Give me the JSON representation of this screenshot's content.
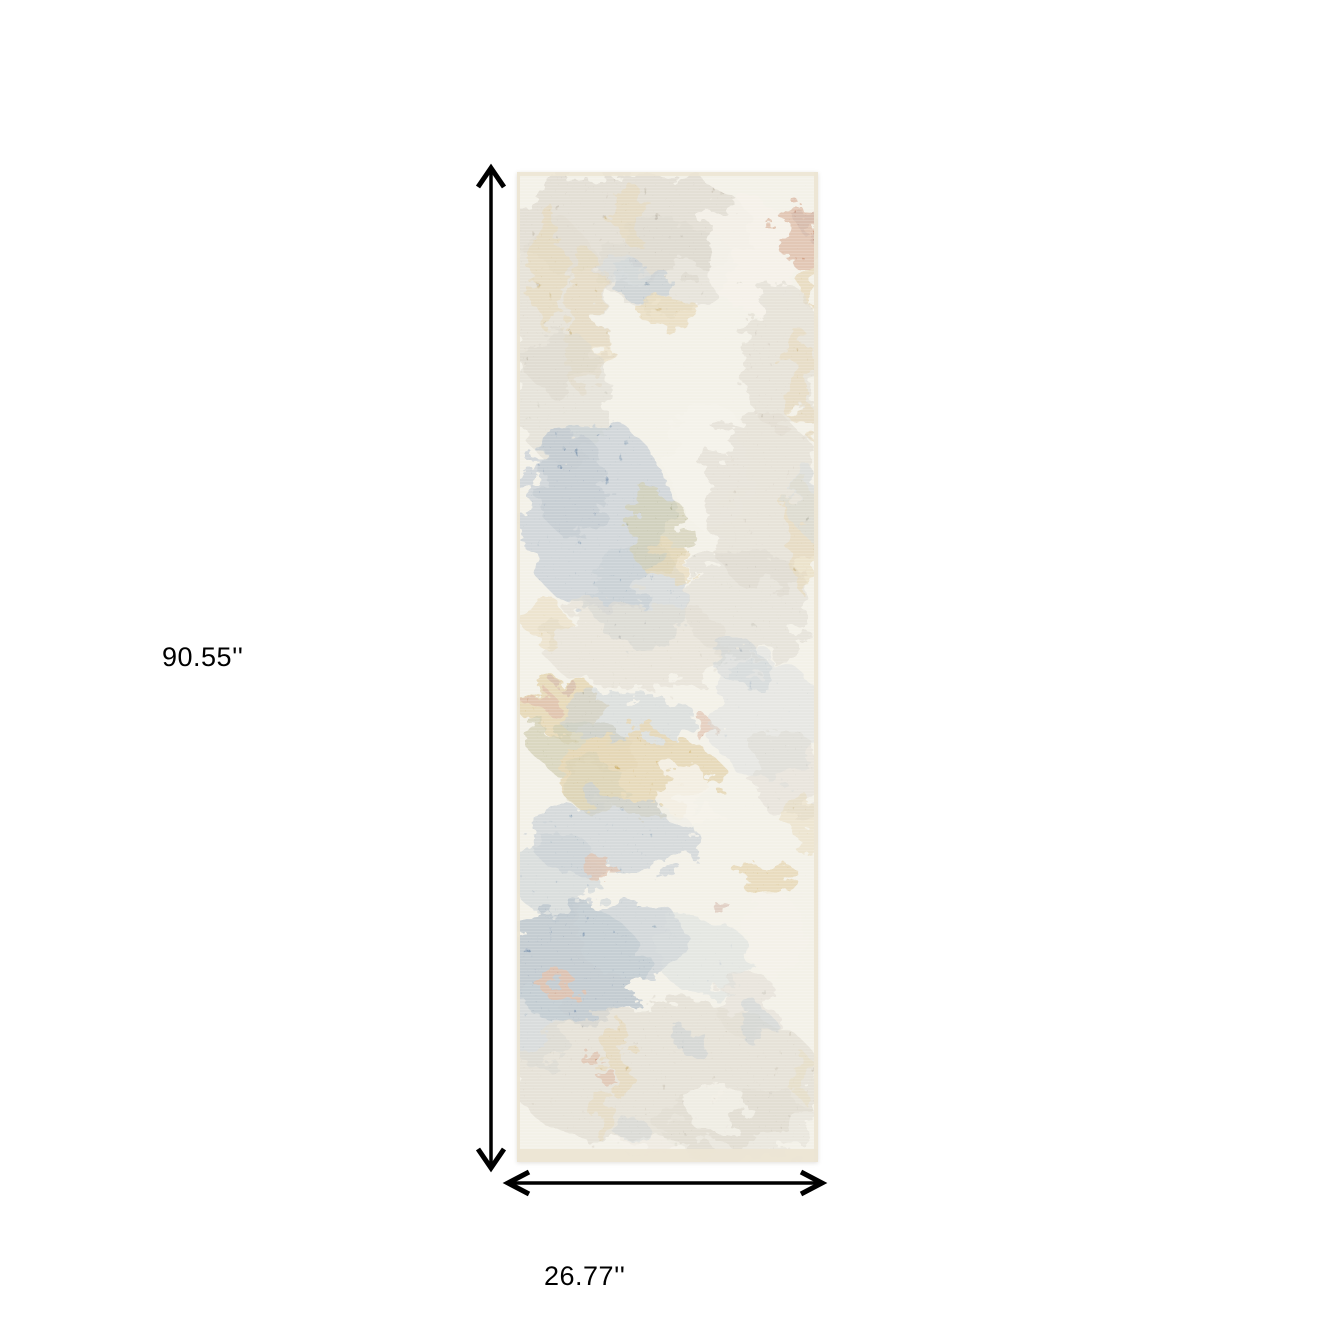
{
  "figure": {
    "height_label": "90.55''",
    "width_label": "26.77''"
  },
  "palette": {
    "background": "#ffffff",
    "arrow": "#000000",
    "text": "#000000",
    "rug_base": "#f1eee5",
    "rug_edge": "#ece5d4",
    "ivory": "#f4f1e8",
    "white_speck": "#f8f6ef",
    "taupe": "#b2a896",
    "gray": "#a09a8d",
    "blue": "#5d7ea1",
    "deep_blue": "#3f6390",
    "light_blue": "#93a9bd",
    "gold": "#c49a3c",
    "olive": "#7f7b33",
    "rust": "#b05428",
    "dark_rust": "#8c3c1e"
  },
  "rug": {
    "pattern": [
      {
        "x": 110,
        "y": 52,
        "rx": 125,
        "ry": 52,
        "c": "taupe",
        "o": 0.85
      },
      {
        "x": 40,
        "y": 135,
        "rx": 50,
        "ry": 85,
        "c": "taupe",
        "o": 0.7
      },
      {
        "x": 150,
        "y": 95,
        "rx": 70,
        "ry": 45,
        "c": "gray",
        "o": 0.5
      },
      {
        "x": 30,
        "y": 95,
        "rx": 14,
        "ry": 65,
        "c": "gold",
        "o": 0.55
      },
      {
        "x": 68,
        "y": 150,
        "rx": 20,
        "ry": 75,
        "c": "gold",
        "o": 0.5
      },
      {
        "x": 112,
        "y": 40,
        "rx": 16,
        "ry": 30,
        "c": "gold",
        "o": 0.5
      },
      {
        "x": 232,
        "y": 82,
        "rx": 46,
        "ry": 55,
        "c": "ivory",
        "o": 0.9
      },
      {
        "x": 283,
        "y": 64,
        "rx": 20,
        "ry": 30,
        "c": "rust",
        "o": 0.9
      },
      {
        "x": 291,
        "y": 50,
        "rx": 10,
        "ry": 14,
        "c": "dark_rust",
        "o": 0.8
      },
      {
        "x": 294,
        "y": 112,
        "rx": 11,
        "ry": 24,
        "c": "gold",
        "o": 0.75
      },
      {
        "x": 126,
        "y": 112,
        "rx": 30,
        "ry": 20,
        "c": "blue",
        "o": 0.7
      },
      {
        "x": 104,
        "y": 96,
        "rx": 20,
        "ry": 12,
        "c": "light_blue",
        "o": 0.6
      },
      {
        "x": 152,
        "y": 140,
        "rx": 32,
        "ry": 14,
        "c": "gold",
        "o": 0.65
      },
      {
        "x": 265,
        "y": 185,
        "rx": 40,
        "ry": 75,
        "c": "taupe",
        "o": 0.65
      },
      {
        "x": 282,
        "y": 205,
        "rx": 12,
        "ry": 50,
        "c": "gold",
        "o": 0.5
      },
      {
        "x": 45,
        "y": 225,
        "rx": 48,
        "ry": 65,
        "c": "gray",
        "o": 0.55
      },
      {
        "x": 80,
        "y": 345,
        "rx": 75,
        "ry": 95,
        "c": "blue",
        "o": 0.75
      },
      {
        "x": 55,
        "y": 312,
        "rx": 35,
        "ry": 52,
        "c": "deep_blue",
        "o": 0.55
      },
      {
        "x": 122,
        "y": 425,
        "rx": 46,
        "ry": 55,
        "c": "blue",
        "o": 0.6
      },
      {
        "x": 142,
        "y": 362,
        "rx": 32,
        "ry": 40,
        "c": "olive",
        "o": 0.7
      },
      {
        "x": 152,
        "y": 392,
        "rx": 26,
        "ry": 18,
        "c": "gold",
        "o": 0.65
      },
      {
        "x": 192,
        "y": 292,
        "rx": 38,
        "ry": 65,
        "c": "ivory",
        "o": 0.88
      },
      {
        "x": 246,
        "y": 330,
        "rx": 58,
        "ry": 90,
        "c": "taupe",
        "o": 0.65
      },
      {
        "x": 230,
        "y": 432,
        "rx": 65,
        "ry": 55,
        "c": "gray",
        "o": 0.5
      },
      {
        "x": 286,
        "y": 362,
        "rx": 13,
        "ry": 60,
        "c": "gold",
        "o": 0.55
      },
      {
        "x": 290,
        "y": 328,
        "rx": 15,
        "ry": 35,
        "c": "light_blue",
        "o": 0.55
      },
      {
        "x": 120,
        "y": 472,
        "rx": 95,
        "ry": 45,
        "c": "taupe",
        "o": 0.55
      },
      {
        "x": 28,
        "y": 448,
        "rx": 18,
        "ry": 26,
        "c": "gold",
        "o": 0.5
      },
      {
        "x": 45,
        "y": 534,
        "rx": 42,
        "ry": 28,
        "c": "gold",
        "o": 0.9
      },
      {
        "x": 22,
        "y": 528,
        "rx": 16,
        "ry": 11,
        "c": "rust",
        "o": 0.85
      },
      {
        "x": 50,
        "y": 514,
        "rx": 10,
        "ry": 7,
        "c": "dark_rust",
        "o": 0.7
      },
      {
        "x": 65,
        "y": 576,
        "rx": 50,
        "ry": 25,
        "c": "olive",
        "o": 0.75
      },
      {
        "x": 110,
        "y": 545,
        "rx": 70,
        "ry": 24,
        "c": "blue",
        "o": 0.5
      },
      {
        "x": 120,
        "y": 602,
        "rx": 85,
        "ry": 42,
        "c": "gold",
        "o": 0.88
      },
      {
        "x": 75,
        "y": 612,
        "rx": 35,
        "ry": 22,
        "c": "olive",
        "o": 0.4
      },
      {
        "x": 95,
        "y": 665,
        "rx": 85,
        "ry": 40,
        "c": "blue",
        "o": 0.65
      },
      {
        "x": 40,
        "y": 702,
        "rx": 45,
        "ry": 42,
        "c": "blue",
        "o": 0.55
      },
      {
        "x": 85,
        "y": 700,
        "rx": 18,
        "ry": 9,
        "c": "rust",
        "o": 0.75
      },
      {
        "x": 190,
        "y": 560,
        "rx": 9,
        "ry": 13,
        "c": "rust",
        "o": 0.7
      },
      {
        "x": 170,
        "y": 625,
        "rx": 28,
        "ry": 32,
        "c": "ivory",
        "o": 0.85
      },
      {
        "x": 250,
        "y": 548,
        "rx": 55,
        "ry": 62,
        "c": "light_blue",
        "o": 0.45
      },
      {
        "x": 272,
        "y": 604,
        "rx": 34,
        "ry": 46,
        "c": "gray",
        "o": 0.45
      },
      {
        "x": 252,
        "y": 706,
        "rx": 30,
        "ry": 20,
        "c": "gold",
        "o": 0.8
      },
      {
        "x": 286,
        "y": 652,
        "rx": 14,
        "ry": 30,
        "c": "gold",
        "o": 0.45
      },
      {
        "x": 224,
        "y": 492,
        "rx": 25,
        "ry": 20,
        "c": "blue",
        "o": 0.45
      },
      {
        "x": 205,
        "y": 736,
        "rx": 9,
        "ry": 7,
        "c": "dark_rust",
        "o": 0.6
      },
      {
        "x": 55,
        "y": 792,
        "rx": 70,
        "ry": 58,
        "c": "deep_blue",
        "o": 0.88
      },
      {
        "x": 115,
        "y": 766,
        "rx": 55,
        "ry": 40,
        "c": "blue",
        "o": 0.72
      },
      {
        "x": 20,
        "y": 852,
        "rx": 30,
        "ry": 42,
        "c": "blue",
        "o": 0.6
      },
      {
        "x": 40,
        "y": 812,
        "rx": 20,
        "ry": 12,
        "c": "rust",
        "o": 0.9
      },
      {
        "x": 185,
        "y": 782,
        "rx": 45,
        "ry": 38,
        "c": "light_blue",
        "o": 0.5
      },
      {
        "x": 256,
        "y": 762,
        "rx": 30,
        "ry": 40,
        "c": "ivory",
        "o": 0.7
      },
      {
        "x": 230,
        "y": 832,
        "rx": 30,
        "ry": 35,
        "c": "gray",
        "o": 0.45
      },
      {
        "x": 150,
        "y": 905,
        "rx": 155,
        "ry": 75,
        "c": "taupe",
        "o": 0.7
      },
      {
        "x": 222,
        "y": 952,
        "rx": 80,
        "ry": 38,
        "c": "gray",
        "o": 0.4
      },
      {
        "x": 200,
        "y": 936,
        "rx": 32,
        "ry": 26,
        "c": "ivory",
        "o": 0.75
      },
      {
        "x": 140,
        "y": 982,
        "rx": 30,
        "ry": 16,
        "c": "ivory",
        "o": 0.6
      },
      {
        "x": 100,
        "y": 885,
        "rx": 13,
        "ry": 40,
        "c": "gold",
        "o": 0.6
      },
      {
        "x": 88,
        "y": 945,
        "rx": 9,
        "ry": 28,
        "c": "gold",
        "o": 0.45
      },
      {
        "x": 78,
        "y": 890,
        "rx": 6,
        "ry": 12,
        "c": "rust",
        "o": 0.75
      },
      {
        "x": 175,
        "y": 870,
        "rx": 13,
        "ry": 16,
        "c": "blue",
        "o": 0.5
      },
      {
        "x": 240,
        "y": 855,
        "rx": 16,
        "ry": 20,
        "c": "blue",
        "o": 0.45
      },
      {
        "x": 120,
        "y": 963,
        "rx": 18,
        "ry": 12,
        "c": "blue",
        "o": 0.35
      },
      {
        "x": 283,
        "y": 902,
        "rx": 10,
        "ry": 24,
        "c": "gold",
        "o": 0.35
      }
    ]
  }
}
